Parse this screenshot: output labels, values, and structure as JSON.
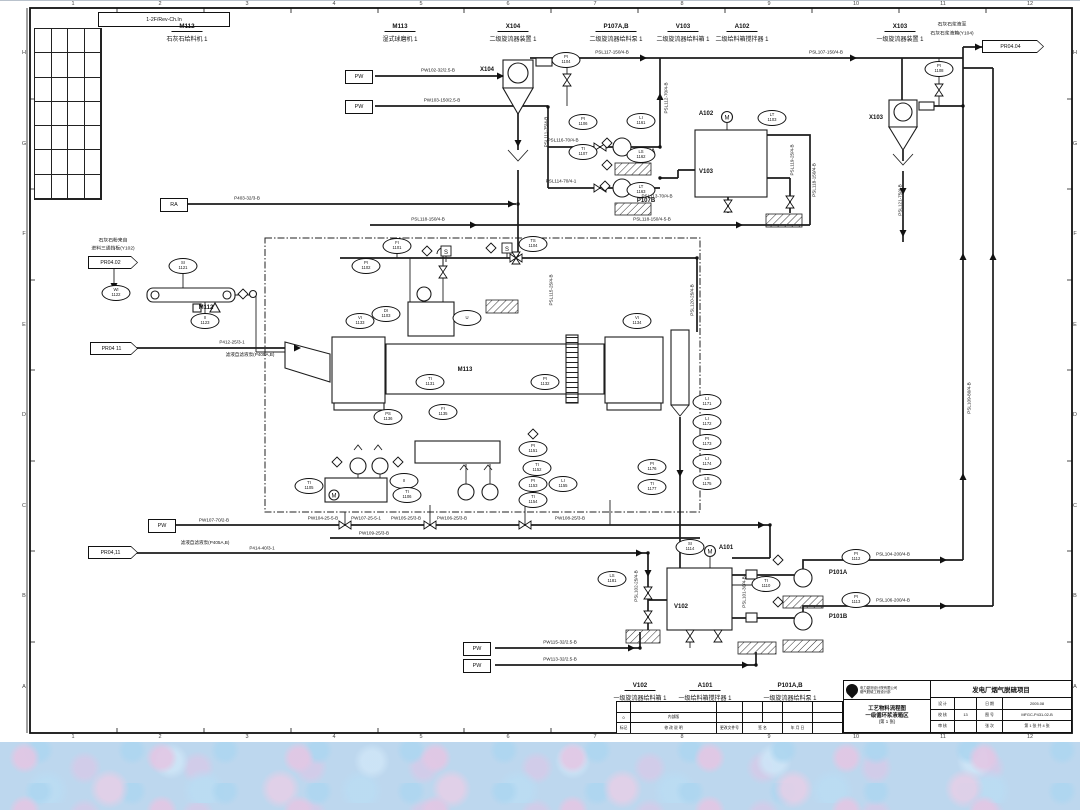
{
  "corner_note": "1-2F/Rev-Ch.In",
  "colors": {
    "ink": "#1c1c1c",
    "paper": "#ffffff",
    "texture": "#bdd7ee"
  },
  "top_equipment": [
    {
      "tag": "M112",
      "name": "石灰石给料机 1",
      "x": 187
    },
    {
      "tag": "M113",
      "name": "湿式球磨机 1",
      "x": 400
    },
    {
      "tag": "X104",
      "name": "二级旋流器装置 1",
      "x": 513
    },
    {
      "tag": "P107A,B",
      "name": "二级旋流器给料泵 1",
      "x": 616
    },
    {
      "tag": "V103",
      "name": "二级旋流器给料箱 1",
      "x": 683
    },
    {
      "tag": "A102",
      "name": "二级给料箱搅拌器 1",
      "x": 742
    },
    {
      "tag": "X103",
      "name": "一级旋流器装置 1",
      "x": 900
    }
  ],
  "bottom_equipment": [
    {
      "tag": "V102",
      "name": "一级旋流器给料箱 1",
      "x": 640
    },
    {
      "tag": "A101",
      "name": "一级给料箱搅拌器 1",
      "x": 705
    },
    {
      "tag": "P101A,B",
      "name": "一级旋流器给料泵 1",
      "x": 790
    }
  ],
  "notes": [
    {
      "text": "石灰石粉来自",
      "x": 113,
      "y": 240
    },
    {
      "text": "进料三通挡板(Y102)",
      "x": 113,
      "y": 248
    },
    {
      "text": "石灰石浆液至",
      "x": 952,
      "y": 24
    },
    {
      "text": "石灰石浆液箱(Y104)",
      "x": 952,
      "y": 33
    }
  ],
  "flags": [
    {
      "label": "PR04.02",
      "x": 88,
      "y": 256,
      "w": 50
    },
    {
      "label": "PR04 11",
      "x": 90,
      "y": 342,
      "w": 48
    },
    {
      "label": "PR04,11",
      "x": 88,
      "y": 546,
      "w": 50
    },
    {
      "label": "PR04.04",
      "x": 982,
      "y": 40,
      "w": 62
    }
  ],
  "small_boxes": [
    {
      "label": "PW",
      "x": 345,
      "y": 70
    },
    {
      "label": "PW",
      "x": 345,
      "y": 100
    },
    {
      "label": "RA",
      "x": 160,
      "y": 198
    },
    {
      "label": "PW",
      "x": 148,
      "y": 519
    },
    {
      "label": "PW",
      "x": 463,
      "y": 642
    },
    {
      "label": "PW",
      "x": 463,
      "y": 659
    }
  ],
  "equipment_tags": [
    {
      "t": "M112",
      "x": 206,
      "y": 308
    },
    {
      "t": "M113",
      "x": 465,
      "y": 370
    },
    {
      "t": "X104",
      "x": 487,
      "y": 70
    },
    {
      "t": "V103",
      "x": 706,
      "y": 172
    },
    {
      "t": "A102",
      "x": 706,
      "y": 114
    },
    {
      "t": "X103",
      "x": 876,
      "y": 118
    },
    {
      "t": "V102",
      "x": 681,
      "y": 607
    },
    {
      "t": "A101",
      "x": 726,
      "y": 548
    },
    {
      "t": "P101A",
      "x": 838,
      "y": 573
    },
    {
      "t": "P101B",
      "x": 838,
      "y": 617
    },
    {
      "t": "P107A",
      "x": 646,
      "y": 152
    },
    {
      "t": "P107B",
      "x": 646,
      "y": 201
    }
  ],
  "instruments": [
    {
      "t": "SI",
      "n": "1121",
      "x": 183,
      "y": 266
    },
    {
      "t": "WI",
      "n": "1122",
      "x": 116,
      "y": 293
    },
    {
      "t": "II",
      "n": "1123",
      "x": 205,
      "y": 321
    },
    {
      "t": "PI",
      "n": "1104",
      "x": 566,
      "y": 60
    },
    {
      "t": "FI",
      "n": "1101",
      "x": 397,
      "y": 246
    },
    {
      "t": "PI",
      "n": "1102",
      "x": 366,
      "y": 266
    },
    {
      "t": "TS",
      "n": "1104",
      "x": 533,
      "y": 244
    },
    {
      "t": "VI",
      "n": "1133",
      "x": 360,
      "y": 321
    },
    {
      "t": "DI",
      "n": "1103",
      "x": 386,
      "y": 314
    },
    {
      "t": "U",
      "n": "",
      "x": 467,
      "y": 318
    },
    {
      "t": "TI",
      "n": "1105",
      "x": 309,
      "y": 486
    },
    {
      "t": "II",
      "n": "",
      "x": 404,
      "y": 481
    },
    {
      "t": "TI",
      "n": "1106",
      "x": 407,
      "y": 495
    },
    {
      "t": "TI",
      "n": "1131",
      "x": 430,
      "y": 382
    },
    {
      "t": "PI",
      "n": "1132",
      "x": 545,
      "y": 382
    },
    {
      "t": "VI",
      "n": "1134",
      "x": 637,
      "y": 321
    },
    {
      "t": "PS",
      "n": "1136",
      "x": 388,
      "y": 417
    },
    {
      "t": "FI",
      "n": "1135",
      "x": 443,
      "y": 412
    },
    {
      "t": "PI",
      "n": "1151",
      "x": 533,
      "y": 449
    },
    {
      "t": "TI",
      "n": "1152",
      "x": 537,
      "y": 468
    },
    {
      "t": "PI",
      "n": "1153",
      "x": 533,
      "y": 484
    },
    {
      "t": "TI",
      "n": "1154",
      "x": 533,
      "y": 500
    },
    {
      "t": "LI",
      "n": "1155",
      "x": 563,
      "y": 484
    },
    {
      "t": "PI",
      "n": "1106",
      "x": 583,
      "y": 122
    },
    {
      "t": "TI",
      "n": "1107",
      "x": 583,
      "y": 152
    },
    {
      "t": "LI",
      "n": "1161",
      "x": 641,
      "y": 121
    },
    {
      "t": "LS",
      "n": "1162",
      "x": 641,
      "y": 155
    },
    {
      "t": "LT",
      "n": "1163",
      "x": 641,
      "y": 190
    },
    {
      "t": "LT",
      "n": "1103",
      "x": 772,
      "y": 118
    },
    {
      "t": "PI",
      "n": "1108",
      "x": 939,
      "y": 69
    },
    {
      "t": "LI",
      "n": "1171",
      "x": 707,
      "y": 402
    },
    {
      "t": "LI",
      "n": "1172",
      "x": 707,
      "y": 422
    },
    {
      "t": "PI",
      "n": "1173",
      "x": 707,
      "y": 442
    },
    {
      "t": "LI",
      "n": "1174",
      "x": 707,
      "y": 462
    },
    {
      "t": "LS",
      "n": "1175",
      "x": 707,
      "y": 482
    },
    {
      "t": "PI",
      "n": "1176",
      "x": 652,
      "y": 467
    },
    {
      "t": "TI",
      "n": "1177",
      "x": 652,
      "y": 487
    },
    {
      "t": "LS",
      "n": "1181",
      "x": 612,
      "y": 579
    },
    {
      "t": "TI",
      "n": "1110",
      "x": 766,
      "y": 584
    },
    {
      "t": "PI",
      "n": "1112",
      "x": 856,
      "y": 557
    },
    {
      "t": "PI",
      "n": "1113",
      "x": 856,
      "y": 600
    },
    {
      "t": "SI",
      "n": "1114",
      "x": 690,
      "y": 547
    }
  ],
  "line_labels": [
    {
      "text": "PW102-32/2.5-B",
      "x": 438,
      "y": 70
    },
    {
      "text": "PW103-150/2.5-B",
      "x": 442,
      "y": 100
    },
    {
      "text": "P403-32/3-B",
      "x": 247,
      "y": 198
    },
    {
      "text": "PSL117-150/4-B",
      "x": 612,
      "y": 52
    },
    {
      "text": "PSL107-150/4-B",
      "x": 826,
      "y": 52
    },
    {
      "text": "PSL118-150/4-B",
      "x": 428,
      "y": 219
    },
    {
      "text": "PSL118-150/4-5-B",
      "x": 652,
      "y": 219
    },
    {
      "text": "P412-25/3-1",
      "x": 232,
      "y": 342
    },
    {
      "text": "滤液自滤液泵(P405A,B)",
      "x": 250,
      "y": 355
    },
    {
      "text": "PSL116-70/4-B",
      "x": 563,
      "y": 140
    },
    {
      "text": "PSL114-70/4-1",
      "x": 561,
      "y": 181
    },
    {
      "text": "PSL113-70/4-B",
      "x": 657,
      "y": 196
    },
    {
      "text": "PW107-70/2-B",
      "x": 214,
      "y": 520
    },
    {
      "text": "PW104-25-5-B",
      "x": 323,
      "y": 518
    },
    {
      "text": "PW107-25-5-1",
      "x": 366,
      "y": 518
    },
    {
      "text": "PW105-25/3-B",
      "x": 406,
      "y": 518
    },
    {
      "text": "PW106-25/3-B",
      "x": 452,
      "y": 518
    },
    {
      "text": "PW108-25/3-B",
      "x": 570,
      "y": 518
    },
    {
      "text": "PW109-25/3-B",
      "x": 374,
      "y": 533
    },
    {
      "text": "P414-40/3-1",
      "x": 262,
      "y": 548
    },
    {
      "text": "滤液自滤液泵(P405A,B)",
      "x": 205,
      "y": 543
    },
    {
      "text": "PW115-32/2.5-B",
      "x": 560,
      "y": 642
    },
    {
      "text": "PW113-32/2.5-B",
      "x": 560,
      "y": 659
    },
    {
      "text": "PSL104-200/4-B",
      "x": 893,
      "y": 554
    },
    {
      "text": "PSL106-200/4-B",
      "x": 893,
      "y": 600
    },
    {
      "text": "PSL111-75/4-B",
      "x": 546,
      "y": 132,
      "rot": true
    },
    {
      "text": "PSL112-70/4-B",
      "x": 666,
      "y": 98,
      "rot": true
    },
    {
      "text": "PSL119-25/4-B",
      "x": 792,
      "y": 160,
      "rot": true
    },
    {
      "text": "PSL121-75/4-B",
      "x": 900,
      "y": 200,
      "rot": true
    },
    {
      "text": "PSL109-80/4-B",
      "x": 969,
      "y": 398,
      "rot": true
    },
    {
      "text": "PSL115-25/4-B",
      "x": 551,
      "y": 290,
      "rot": true
    },
    {
      "text": "PSL102-25/4-B",
      "x": 636,
      "y": 586,
      "rot": true
    },
    {
      "text": "PSL101-30/4-B",
      "x": 744,
      "y": 592,
      "rot": true
    },
    {
      "text": "PSL120-25/4-B",
      "x": 692,
      "y": 300,
      "rot": true
    },
    {
      "text": "PSL118-150/4-B",
      "x": 814,
      "y": 180,
      "rot": true
    }
  ],
  "zone_numbers": [
    {
      "t": "1",
      "x": 73
    },
    {
      "t": "2",
      "x": 160
    },
    {
      "t": "3",
      "x": 247
    },
    {
      "t": "4",
      "x": 334
    },
    {
      "t": "5",
      "x": 421
    },
    {
      "t": "6",
      "x": 508
    },
    {
      "t": "7",
      "x": 595
    },
    {
      "t": "8",
      "x": 682
    },
    {
      "t": "9",
      "x": 769
    },
    {
      "t": "10",
      "x": 856
    },
    {
      "t": "11",
      "x": 943
    },
    {
      "t": "12",
      "x": 1030
    }
  ],
  "zone_letters": [
    {
      "t": "H",
      "y": 53
    },
    {
      "t": "G",
      "y": 144
    },
    {
      "t": "F",
      "y": 234
    },
    {
      "t": "E",
      "y": 325
    },
    {
      "t": "D",
      "y": 415
    },
    {
      "t": "C",
      "y": 506
    },
    {
      "t": "B",
      "y": 596
    },
    {
      "t": "A",
      "y": 687
    }
  ],
  "title_block": {
    "company_lines": [
      "电力勘测设计院有限公司",
      "烟气脱硫工程设计部"
    ],
    "drawing_title_lines": [
      "工艺物料流程图",
      "一级循环浆液箱区",
      "(第 1 张)"
    ],
    "project_title": "发电厂烟气脱硫项目",
    "grid_rows": [
      [
        "设 计",
        "",
        "日 期",
        "2005.08"
      ],
      [
        "校 核",
        "13",
        "图 号",
        "MFGC-P431-02-B"
      ],
      [
        "审 核",
        "",
        "张 次",
        "第 1 张 共 4 张"
      ]
    ],
    "rev_row1": [
      "",
      "",
      "",
      "",
      "",
      "",
      ""
    ],
    "rev_row2": [
      "0",
      "内部版",
      "",
      "",
      "",
      "",
      ""
    ],
    "rev_footer": [
      "标记",
      "修 改 说 明",
      "更改文件号",
      "签 名",
      "年 月 日",
      ""
    ]
  }
}
